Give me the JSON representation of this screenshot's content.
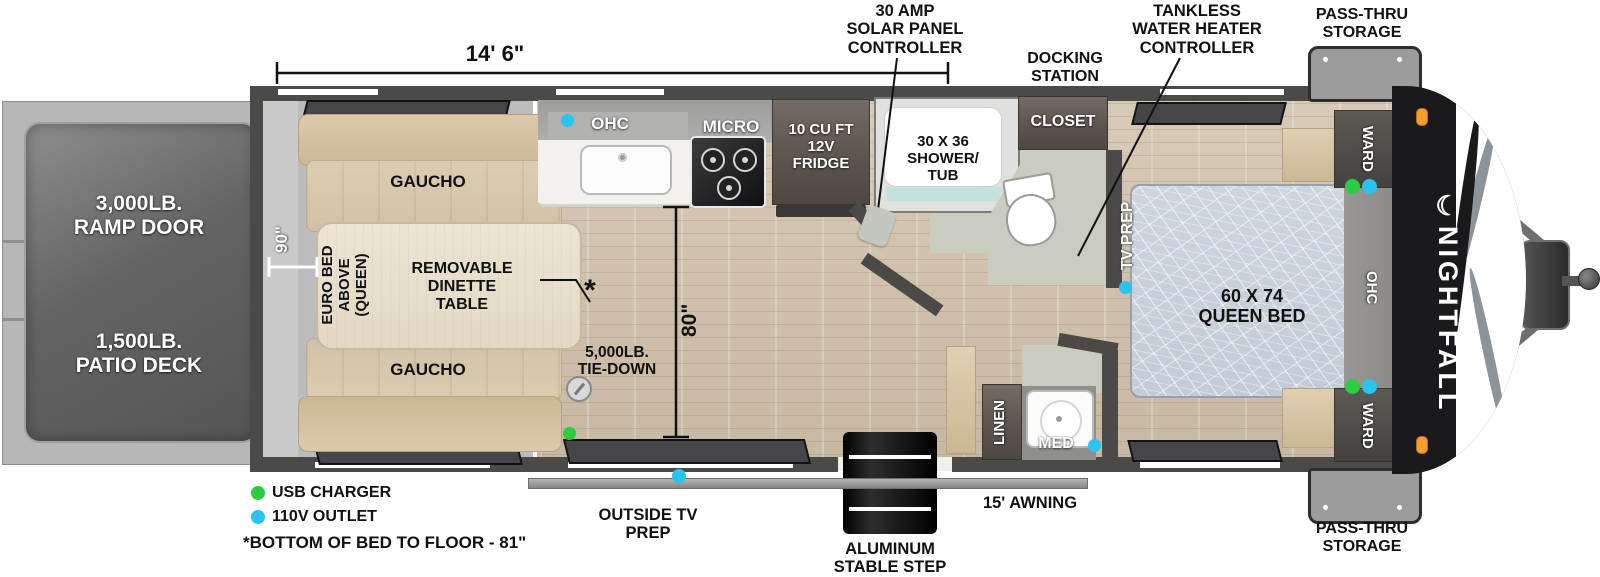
{
  "brand": {
    "name": "NIGHTFALL",
    "logo_mark": "☾"
  },
  "dimensions": {
    "overall_length": "14' 6\"",
    "garage_depth": "90\"",
    "interior_clearance": "80\"",
    "footnote_marker": "*"
  },
  "callouts": {
    "solar": "30 AMP\nSOLAR PANEL\nCONTROLLER",
    "tankless": "TANKLESS\nWATER HEATER\nCONTROLLER",
    "docking_station": "DOCKING\nSTATION",
    "pass_thru_top": "PASS-THRU\nSTORAGE",
    "pass_thru_bottom": "PASS-THRU\nSTORAGE"
  },
  "exterior": {
    "ramp_door": "3,000LB.\nRAMP DOOR",
    "patio_deck": "1,500LB.\nPATIO DECK",
    "awning": "15' AWNING",
    "step": "ALUMINUM\nSTABLE STEP",
    "outside_tv": "OUTSIDE TV\nPREP"
  },
  "garage": {
    "gaucho_top": "GAUCHO",
    "gaucho_bottom": "GAUCHO",
    "euro_bed": "EURO BED\nABOVE\n(QUEEN)",
    "dinette_table": "REMOVABLE\nDINETTE\nTABLE",
    "tie_down": "5,000LB.\nTIE-DOWN"
  },
  "kitchen": {
    "ohc": "OHC",
    "micro": "MICRO",
    "fridge": "10 CU FT\n12V\nFRIDGE"
  },
  "bath": {
    "shower": "30 X 36\nSHOWER/\nTUB",
    "closet": "CLOSET",
    "linen": "LINEN",
    "med": "MED"
  },
  "bedroom": {
    "bed": "60 X 74\nQUEEN BED",
    "tv_prep": "TV PREP",
    "ward_top": "WARD",
    "ward_bottom": "WARD",
    "ohc": "OHC"
  },
  "legend": {
    "usb": "USB CHARGER",
    "outlet": "110V OUTLET",
    "footnote": "*BOTTOM OF BED TO FLOOR - 81\""
  },
  "colors": {
    "usb_green": "#2ecc40",
    "outlet_cyan": "#29c4f0",
    "clearance_orange": "#f59e2d",
    "wall_dark": "#4b4a47",
    "wood_floor": "#cfc2ae",
    "sofa_tan": "#d6c4a6",
    "bed_blue": "#c8d1da"
  }
}
